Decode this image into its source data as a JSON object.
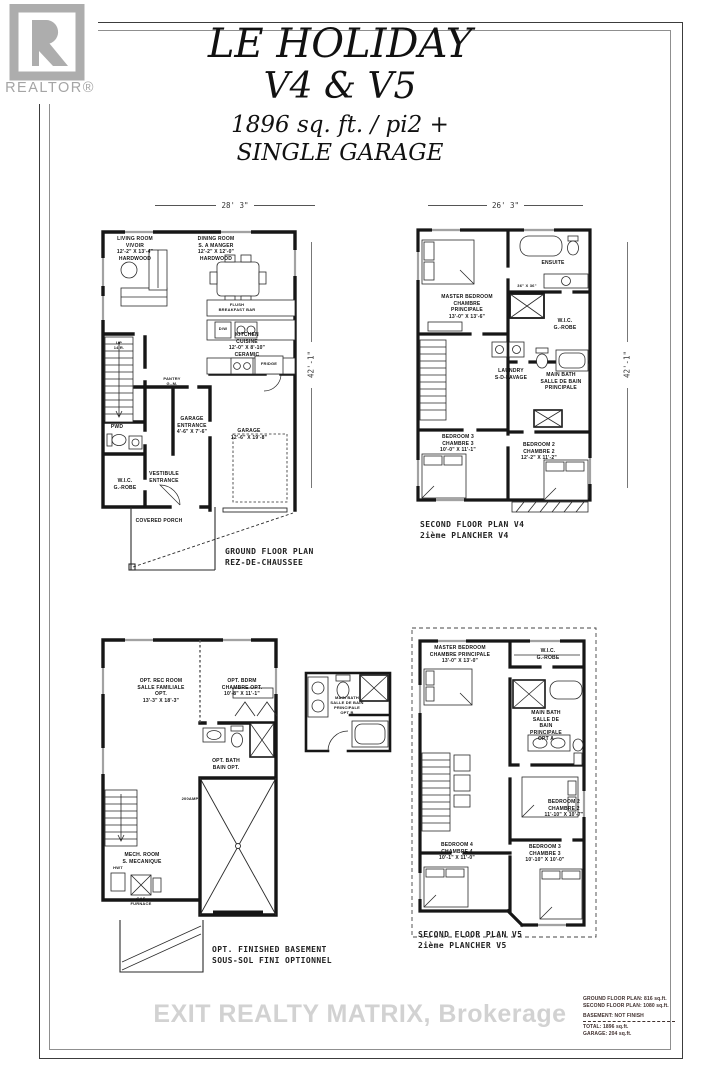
{
  "logo": {
    "brand": "REALTOR®"
  },
  "title": {
    "line1": "LE HOLIDAY",
    "line2": "V4 & V5",
    "line3": "1896 sq. ft. / pi2 +",
    "line4": "SINGLE GARAGE"
  },
  "ground_floor": {
    "width_dim": "28' 3\"",
    "height_dim": "42'-1\"",
    "caption": "GROUND FLOOR PLAN\nREZ-DE-CHAUSSEE",
    "labels": {
      "living": "LIVING ROOM\nVIVOIR\n12'-2\" X 13'-4\"\nHARDWOOD",
      "dining": "DINING ROOM\nS. A MANGER\n12'-2\" X 12'-0\"\nHARDWOOD",
      "flush_bar": "FLUSH\nBREAKFAST BAR",
      "dw": "D/W",
      "kitchen": "KITCHEN\nCUISINE\n12'-0\" X 8'-10\"\nCERAMIC",
      "fridge": "FRIDGE",
      "pantry": "PANTRY\nG.-M.",
      "up": "UP\n14 R.",
      "pwd": "PWD",
      "garage_entrance": "GARAGE\nENTRANCE\n4'-6\" X 7'-6\"",
      "garage": "GARAGE\n12'-6\" X 19'-8\"",
      "wic": "W.I.C.\nG.-ROBE",
      "vestibule": "VESTIBULE\nENTRANCE",
      "porch": "COVERED PORCH"
    }
  },
  "second_floor_v4": {
    "width_dim": "26' 3\"",
    "height_dim": "42'-1\"",
    "caption": "SECOND FLOOR PLAN V4\n2ième PLANCHER V4",
    "labels": {
      "master": "MASTER BEDROOM\nCHAMBRE PRINCIPALE\n13'-0\" X 13'-6\"",
      "ensuite": "ENSUITE",
      "shower": "36\" X 36\"",
      "wic": "W.I.C.\nG.-ROBE",
      "laundry": "LAUNDRY\nS-D-LAVAGE",
      "main_bath": "MAIN BATH\nSALLE DE BAIN\nPRINCIPALE",
      "bedroom3": "BEDROOM 3\nCHAMBRE 3\n10'-0\" X 11'-1\"",
      "bedroom2": "BEDROOM 2\nCHAMBRE 2\n12'-2\" X 11'-2\""
    }
  },
  "basement": {
    "caption": "OPT. FINISHED BASEMENT\nSOUS-SOL FINI OPTIONNEL",
    "labels": {
      "rec": "OPT. REC ROOM\nSALLE FAMILIALE OPT.\n13'-3\" X 18'-3\"",
      "bdrm": "OPT. BDRM\nCHAMBRE OPT.\n10'-8\" X 11'-1\"",
      "bath": "OPT. BATH\nBAIN OPT.",
      "mech": "MECH. ROOM\nS. MECANIQUE",
      "panel": "200AMP",
      "furnace": "GAS\nFURNACE",
      "hwt": "HWT"
    }
  },
  "bath_option": {
    "label": "MAIN BATH\nSALLE DE BAIN\nPRINCIPALE\nOPT B"
  },
  "second_floor_v5": {
    "caption": "SECOND FLOOR PLAN V5\n2ième PLANCHER V5",
    "labels": {
      "master": "MASTER BEDROOM\nCHAMBRE PRINCIPALE\n13'-0\" X 13'-0\"",
      "wic": "W.I.C.\nG.-ROBE",
      "main_bath": "MAIN BATH\nSALLE DE BAIN\nPRINCIPALE\nOPT A",
      "bedroom2": "BEDROOM 2\nCHAMBRE 2\n11'-10\" X 10'-7\"",
      "bedroom3": "BEDROOM 3\nCHAMBRE 3\n10'-10\" X 10'-0\"",
      "bedroom4": "BEDROOM 4\nCHAMBRE 4\n10'-1\" X 11'-0\""
    }
  },
  "stats": {
    "lines": [
      "GROUND FLOOR PLAN: 816 sq.ft.",
      "SECOND FLOOR PLAN: 1080 sq.ft.",
      "BASEMENT: NOT FINISH",
      "TOTAL: 1896 sq.ft.",
      "GARAGE: 204 sq.ft."
    ]
  },
  "watermark": "EXIT REALTY MATRIX, Brokerage"
}
